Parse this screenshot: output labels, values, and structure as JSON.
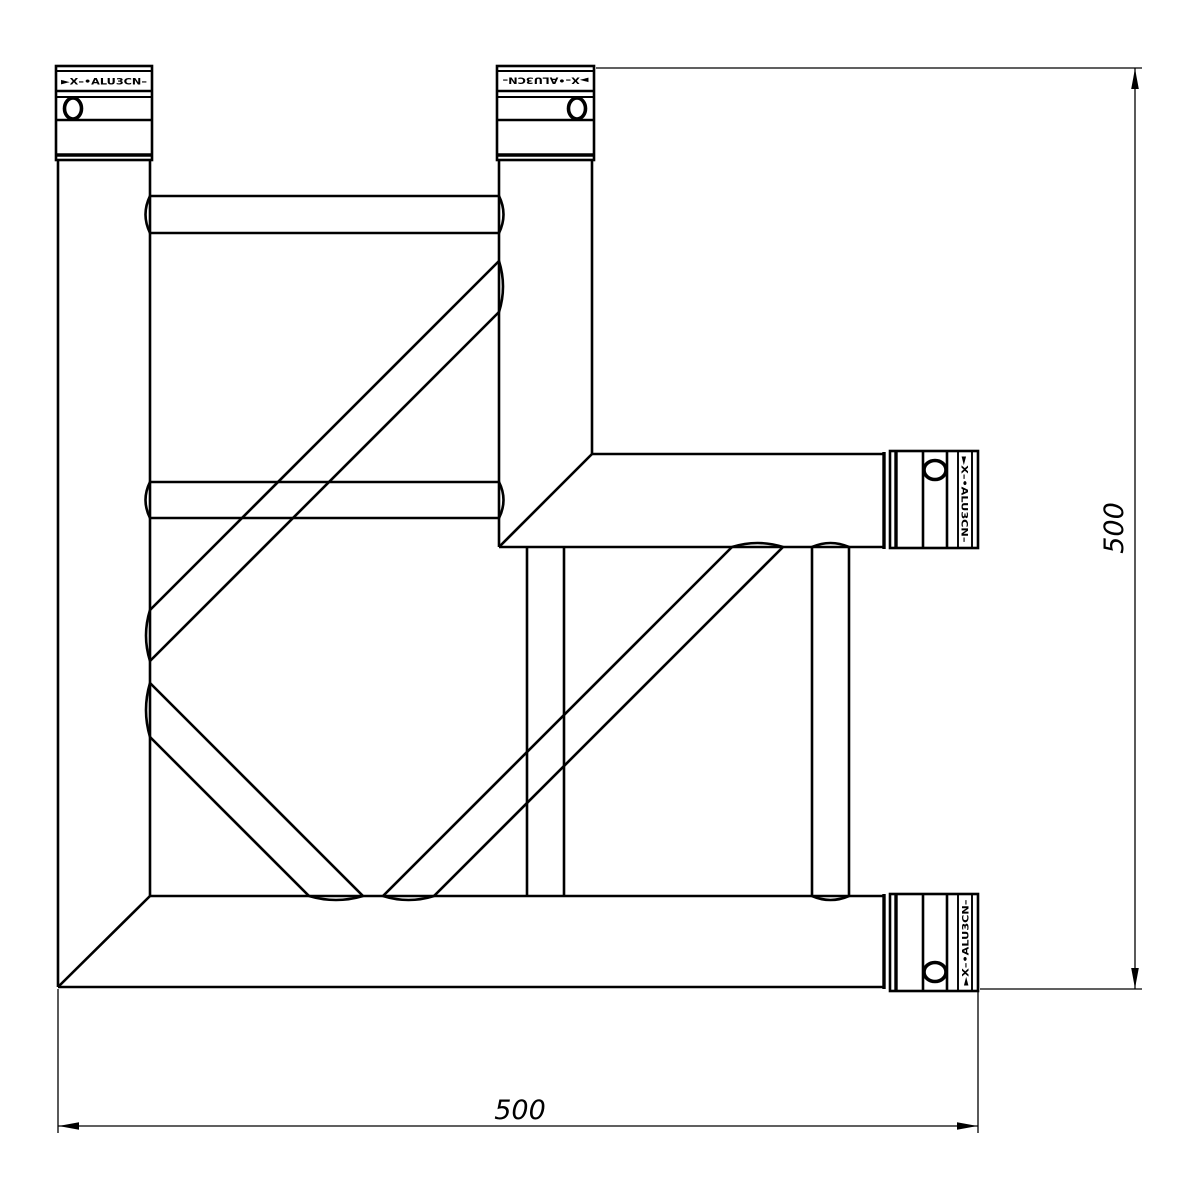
{
  "drawing": {
    "description": "Technical line drawing of a 2-way 90-degree corner truss segment with four coupler ends",
    "background_color": "#ffffff",
    "line_color": "#000000",
    "dimensions": {
      "vertical": "500",
      "horizontal": "500"
    },
    "connector_marking": "►X–•ALU3CN–"
  }
}
